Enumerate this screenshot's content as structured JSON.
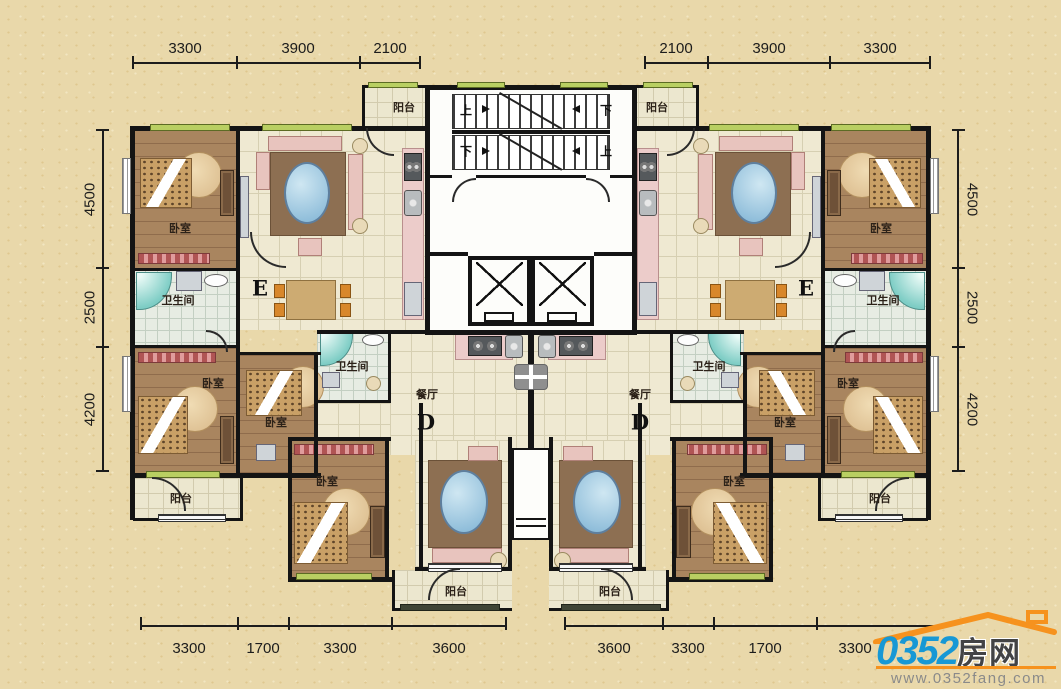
{
  "dimensions": {
    "top_left": [
      "3300",
      "3900",
      "2100"
    ],
    "top_right": [
      "2100",
      "3900",
      "3300"
    ],
    "left_side": [
      "4500",
      "2500",
      "4200"
    ],
    "right_side": [
      "4500",
      "2500",
      "4200"
    ],
    "bottom_left": [
      "3300",
      "1700",
      "3300",
      "3600"
    ],
    "bottom_right": [
      "3600",
      "3300",
      "1700",
      "3300"
    ]
  },
  "labels": {
    "bedroom": "卧室",
    "bathroom": "卫生间",
    "balcony": "阳台",
    "dining_room": "餐厅",
    "unit_e": "E",
    "unit_d": "D",
    "stairs_up": "上",
    "stairs_down": "下"
  },
  "logo": {
    "brand_number": "0352",
    "brand_suffix": "房网",
    "website": "www.0352fang.com"
  },
  "colors": {
    "background": "#e9d8aa",
    "wall": "#141414",
    "bedroom_floor": "#a9855f",
    "tile_floor": "#efe9d2",
    "window_green": "#b9cf62",
    "logo_blue": "#1798d5",
    "logo_orange": "#f6921e"
  }
}
